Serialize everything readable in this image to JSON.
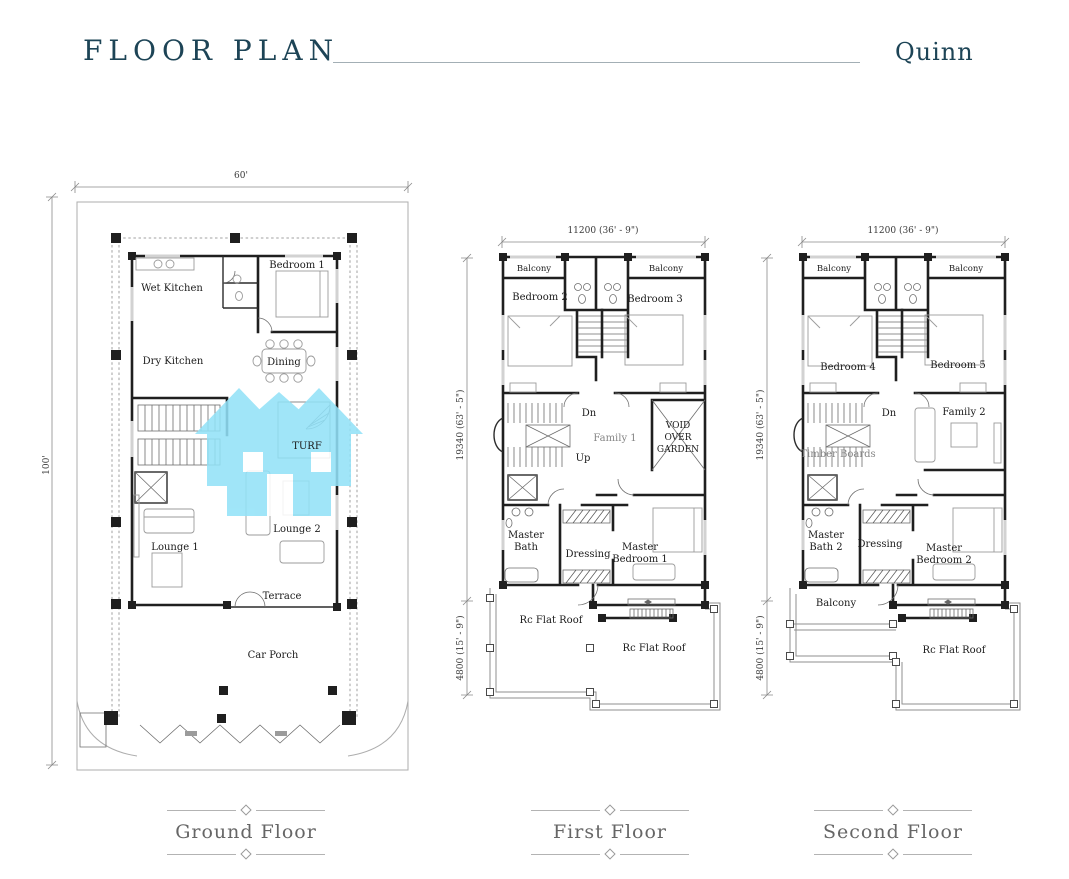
{
  "header": {
    "title": "FLOOR PLAN",
    "project": "Quinn"
  },
  "colors": {
    "title_text": "#1d4456",
    "watermark": "#92E2F8",
    "caption_text": "#666666",
    "wall": "#1f1f1f"
  },
  "floors": {
    "ground": {
      "caption": "Ground Floor",
      "dims": {
        "width": "60'",
        "height": "100'"
      },
      "labels": {
        "wet_kitchen": "Wet Kitchen",
        "bedroom_1": "Bedroom 1",
        "dry_kitchen": "Dry Kitchen",
        "dining": "Dining",
        "turf": "TURF",
        "lounge_1": "Lounge 1",
        "lounge_2": "Lounge 2",
        "terrace": "Terrace",
        "car_porch": "Car Porch"
      }
    },
    "first": {
      "caption": "First Floor",
      "dims": {
        "width": "11200 (36' - 9\")",
        "height_upper": "19340 (63' - 5\")",
        "height_lower": "4800 (15' - 9\")"
      },
      "labels": {
        "balcony_left": "Balcony",
        "balcony_right": "Balcony",
        "bedroom_2": "Bedroom 2",
        "bedroom_3": "Bedroom 3",
        "dn": "Dn",
        "up": "Up",
        "family": "Family 1",
        "void_1": "VOID",
        "void_2": "OVER",
        "void_3": "GARDEN",
        "master_bath_1": "Master",
        "master_bath_2": "Bath",
        "dressing": "Dressing",
        "master_bedroom_1": "Master",
        "master_bedroom_2": "Bedroom 1",
        "rc_flat_roof_left": "Rc Flat Roof",
        "rc_flat_roof_right": "Rc Flat Roof"
      }
    },
    "second": {
      "caption": "Second Floor",
      "dims": {
        "width": "11200 (36' - 9\")",
        "height_upper": "19340 (63' - 5\")",
        "height_lower": "4800 (15' - 9\")"
      },
      "labels": {
        "balcony_left": "Balcony",
        "balcony_right": "Balcony",
        "bedroom_4": "Bedroom 4",
        "bedroom_5": "Bedroom 5",
        "dn": "Dn",
        "timber_boards": "Timber Boards",
        "family": "Family 2",
        "master_bath_1": "Master",
        "master_bath_2": "Bath 2",
        "dressing": "Dressing",
        "master_bedroom_1": "Master",
        "master_bedroom_2": "Bedroom 2",
        "balcony_bottom": "Balcony",
        "rc_flat_roof": "Rc Flat Roof"
      }
    }
  }
}
